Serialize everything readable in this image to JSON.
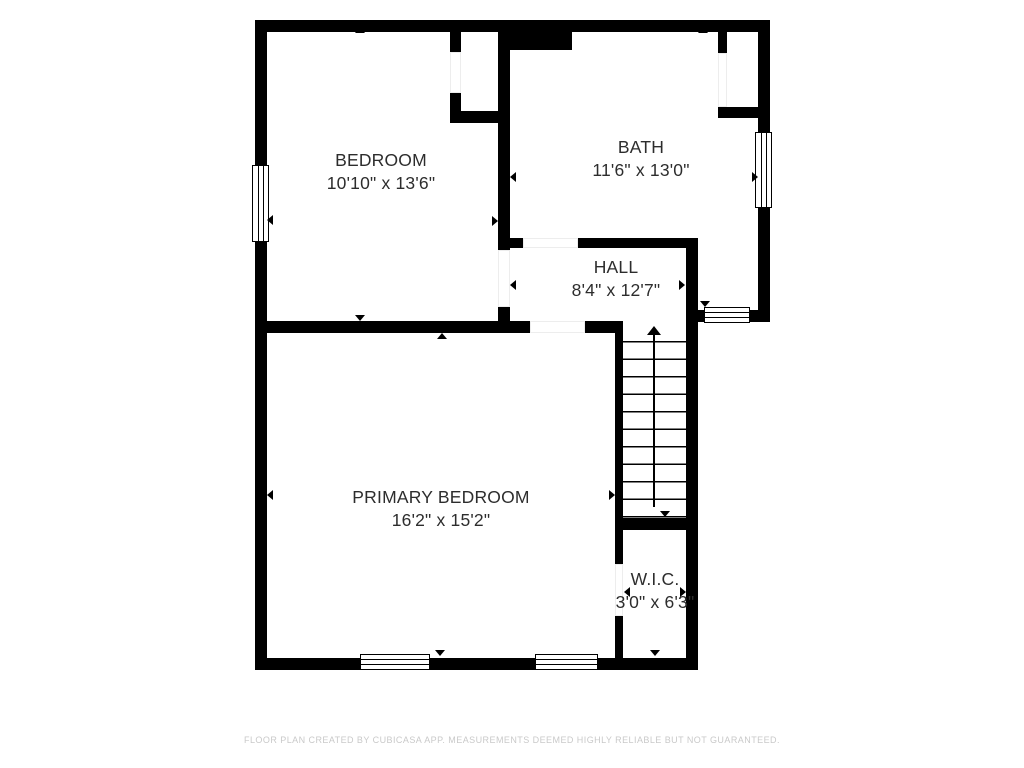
{
  "floorplan": {
    "rooms": [
      {
        "name": "BEDROOM",
        "dimensions": "10'10\" x 13'6\""
      },
      {
        "name": "BATH",
        "dimensions": "11'6\" x 13'0\""
      },
      {
        "name": "HALL",
        "dimensions": "8'4\" x 12'7\""
      },
      {
        "name": "PRIMARY BEDROOM",
        "dimensions": "16'2\" x 15'2\""
      },
      {
        "name": "W.I.C.",
        "dimensions": "3'0\" x 6'3\""
      }
    ],
    "stairs_direction": "up",
    "footer": "FLOOR PLAN CREATED BY CUBICASA APP. MEASUREMENTS DEEMED HIGHLY RELIABLE BUT NOT GUARANTEED.",
    "colors": {
      "wall": "#000000",
      "room_text": "#2d2d2d",
      "footer_text": "#c9c9c9",
      "background": "#ffffff"
    }
  }
}
